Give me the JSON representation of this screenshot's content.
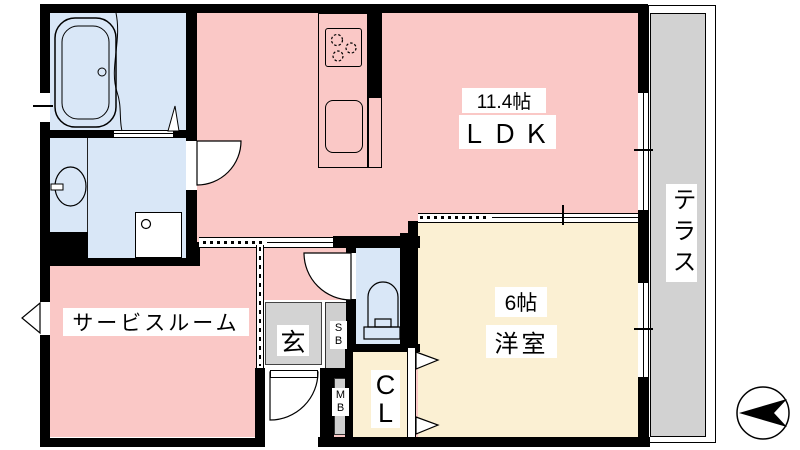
{
  "floorplan": {
    "rooms": {
      "ldk": {
        "size_label": "11.4帖",
        "name_label": "ＬＤＫ",
        "color": "#FAC8C6"
      },
      "western": {
        "size_label": "6帖",
        "name_label": "洋室",
        "color": "#FBF0D3"
      },
      "service": {
        "name_label": "サービスルーム",
        "color": "#FAC8C6"
      },
      "entrance": {
        "name_label": "玄",
        "color": "#D3D3D3"
      },
      "terrace": {
        "name_label": "テラス",
        "color": "#D2D2D2"
      },
      "closet": {
        "chars": [
          "C",
          "L"
        ],
        "color": "#FBF0D3"
      },
      "shoe_box": {
        "chars": [
          "S",
          "B"
        ],
        "color": "#CFCFCF"
      },
      "meter_box": {
        "chars": [
          "M",
          "B"
        ],
        "color": "#CFCFCF"
      },
      "bathroom": {
        "color": "#D9E7F7"
      },
      "toilet": {
        "color": "#D9E7F7"
      }
    },
    "colors": {
      "wall": "#000000",
      "floor_pink": "#FAC8C6",
      "floor_cream": "#FBF0D3",
      "wet_area_blue": "#D9E7F7",
      "terrace_gray": "#D2D2D2"
    },
    "icons": [
      "bathtub-icon",
      "washbasin-icon",
      "washing-machine-icon",
      "stove-icon",
      "kitchen-sink-icon",
      "toilet-icon",
      "door-arc-icon",
      "compass-icon"
    ]
  }
}
